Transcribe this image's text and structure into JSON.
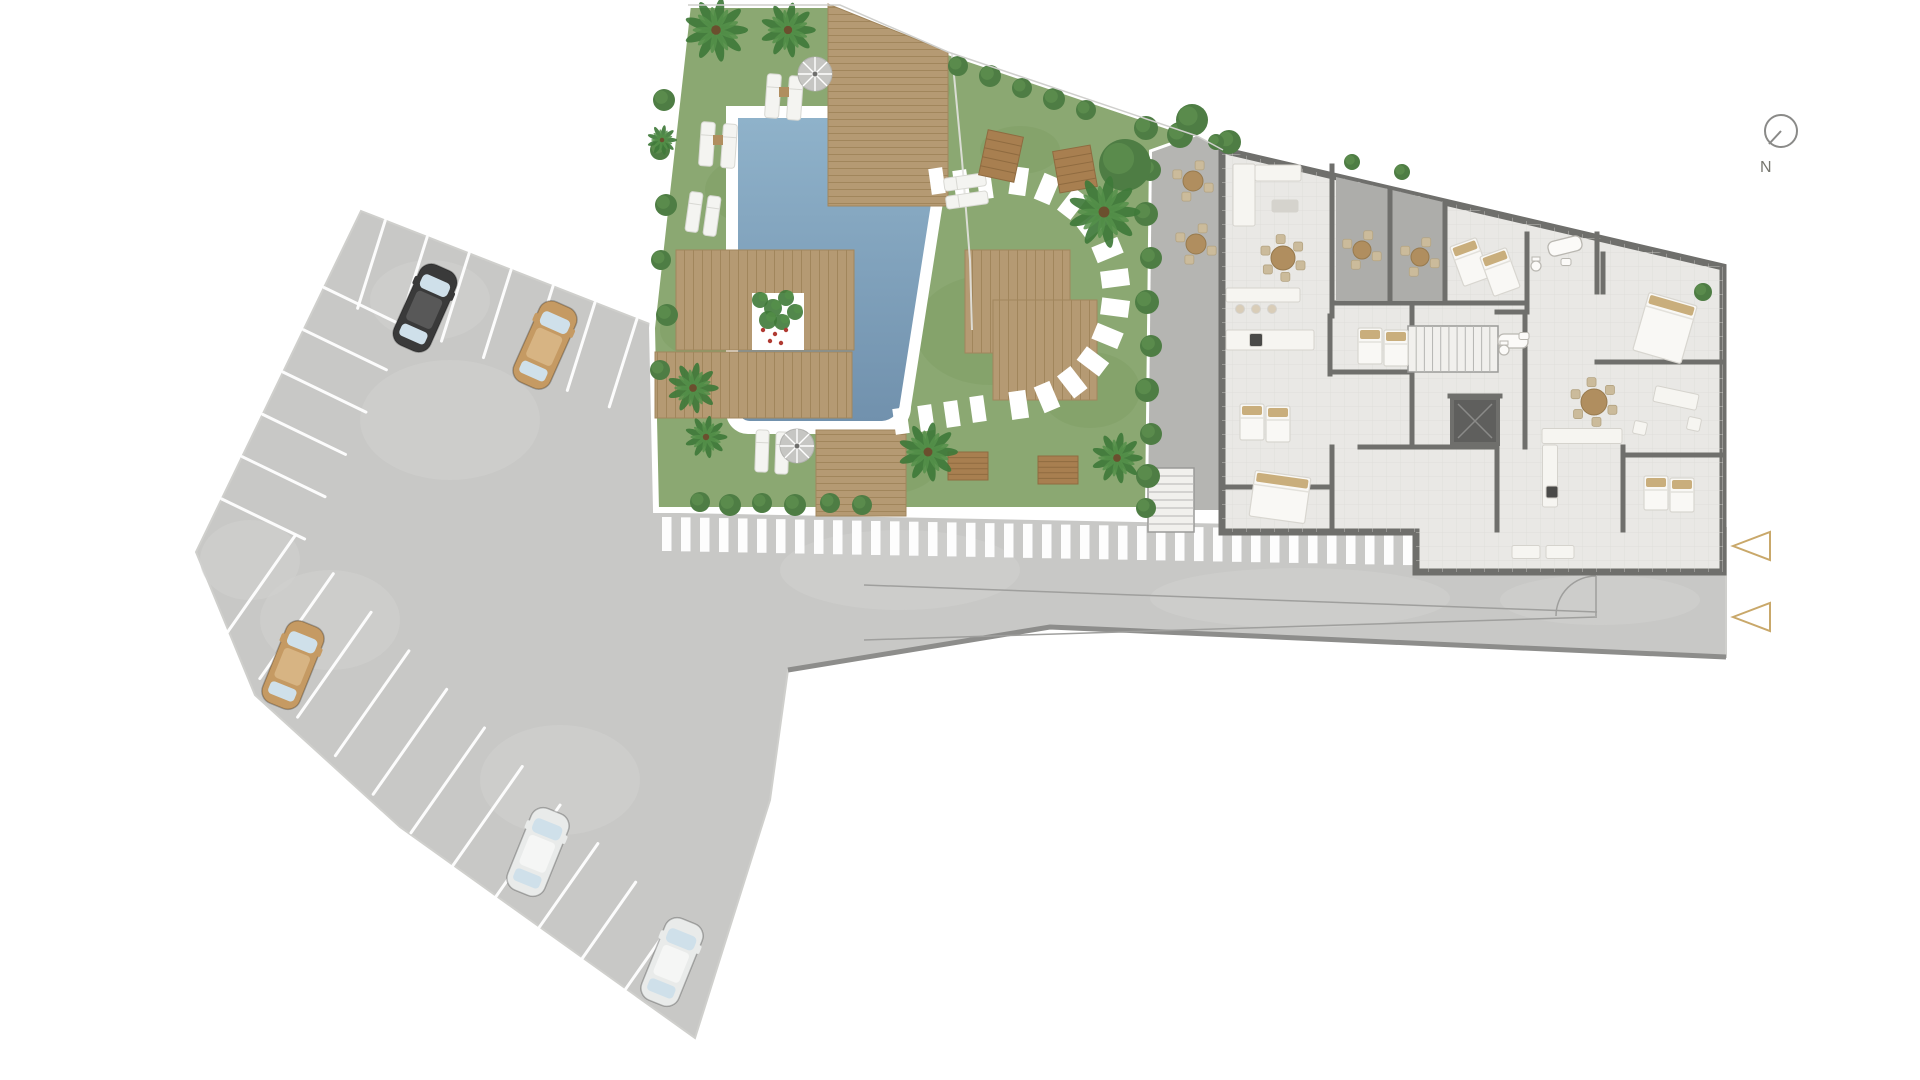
{
  "title": "residential-site-plan",
  "compass": {
    "label": "N",
    "cx": 1781,
    "cy": 131,
    "r": 16,
    "needle_x2": 1769,
    "needle_y2": 144,
    "label_x": 1760,
    "label_y": 172
  },
  "markers": [
    {
      "x": 1733,
      "y": 532,
      "w": 37,
      "h": 28,
      "dir": "left"
    },
    {
      "x": 1733,
      "y": 603,
      "w": 37,
      "h": 28,
      "dir": "left"
    }
  ],
  "colors": {
    "bg": "#ffffff",
    "asphalt": "#c8c8c6",
    "asphalt_light": "#d2d2d0",
    "asphalt_dark": "#bcbcba",
    "curb": "#8d8d8b",
    "lot_line": "#ffffff",
    "guide": "#9f9f9d",
    "grass": "#8ba872",
    "grass_dark": "#7c9a62",
    "bush": "#4e7d44",
    "bush_light": "#5f9150",
    "palm": "#3f7a39",
    "palm_light": "#55904a",
    "trunk": "#6b4f2e",
    "deck": "#b59a73",
    "deck_line": "#a1865c",
    "bench": "#a87f50",
    "bench_line": "#8f6b40",
    "pool_rim": "#ffffff",
    "water_top": "#8fb2ca",
    "water_bottom": "#7191ad",
    "stone": "#ffffff",
    "floor": "#e9e8e5",
    "tile": "#dddcd8",
    "wall": "#6f6f6c",
    "terrace": "#adadaa",
    "patio": "#b5b5b2",
    "furn": "#f6f5f1",
    "furn_stroke": "#d5d3cd",
    "pillow": "#c9ae7c",
    "wood": "#b08e5f",
    "appliance": "#4a4a48",
    "elevator": "#5f5f5d",
    "marker": "#c9a86a",
    "compass": "#8a8a88",
    "label": "#77776f",
    "boundary": "#cfcfcc",
    "fixture": "#fbfaf8",
    "fixture_stroke": "#b9b7b1",
    "glass": "#cfe0ea",
    "stairs": "#f1f0ed"
  },
  "site_paths": {
    "lot_road": "M361,211 L652,325 L656,510 L1726,528 L1726,657 L1050,627 L788,670 L770,800 L695,1038 L400,827 L255,695 L196,552 Z",
    "garden": "M688,5 L840,5 L948,52 L1197,136 L1152,152 L1148,510 L656,510 L652,328 Z",
    "patio": "M1152,152 L1197,136 L1223,150 L1223,510 L1148,510 Z",
    "building": "M1222,150 L1723,267 L1723,572 L1416,572 L1416,532 L1222,532 Z",
    "boundary": "688,5 840,5 948,52 1197,136 1223,150",
    "fence": "952,54 962,160 970,260 972,330",
    "curb_bottom": "1726,657 1050,627 788,670",
    "gate_arc": "M1556,616 A40,40 0 0 1 1596,576 M1596,576 L1596,616"
  },
  "pool": {
    "rim": "M726,106 L884,106 A63,66 0 0 1 947,177 L911,407 A27,27 0 0 1 886,434 L748,434 A22,22 0 0 1 726,412 Z",
    "water": "M738,118 L880,118 A55,57 0 0 1 935,178 L900,403 A19,19 0 0 1 882,421 L750,421 A12,12 0 0 1 738,409 Z"
  },
  "stall_rows": [
    {
      "x": 361,
      "y": 211,
      "dx": 0.932,
      "dy": 0.365,
      "nx": -0.3,
      "ny": 0.954,
      "len": 92,
      "t0": 26,
      "step": 45,
      "n": 7
    },
    {
      "x": 361,
      "y": 211,
      "dx": -0.435,
      "dy": 0.9,
      "nx": 0.9,
      "ny": 0.435,
      "len": 92,
      "t0": 85,
      "step": 47,
      "n": 6
    },
    {
      "x": 222,
      "y": 640,
      "dx": 0.7,
      "dy": 0.714,
      "nx": 0.574,
      "ny": -0.819,
      "len": 128,
      "t0": 0,
      "step": 54,
      "n": 11
    }
  ],
  "cars": [
    {
      "name": "car-black",
      "body": "#3a3a3a",
      "roof": "#585858",
      "x": 425,
      "y": 308,
      "rot": 24
    },
    {
      "name": "car-tan-top",
      "body": "#c59a63",
      "roof": "#d7b483",
      "x": 545,
      "y": 345,
      "rot": 24
    },
    {
      "name": "car-tan-mid",
      "body": "#c59a63",
      "roof": "#d7b483",
      "x": 293,
      "y": 665,
      "rot": 22
    },
    {
      "name": "car-white-1",
      "body": "#e9ebea",
      "roof": "#f5f6f5",
      "x": 538,
      "y": 852,
      "rot": 22
    },
    {
      "name": "car-white-2",
      "body": "#e9ebea",
      "roof": "#f5f6f5",
      "x": 672,
      "y": 962,
      "rot": 22
    }
  ],
  "crosswalk": {
    "x0": 662,
    "x1": 1404,
    "step": 19,
    "w": 9.5,
    "h": 34,
    "y0": 517,
    "slope": 0.019
  },
  "sidewalk": {
    "x1": 654,
    "y1": 508,
    "x2": 1416,
    "y2": 523
  },
  "guide_lines": [
    [
      864,
      585,
      1597,
      612
    ],
    [
      864,
      640,
      1597,
      617
    ]
  ],
  "road_patches": [
    [
      450,
      420,
      90,
      60
    ],
    [
      330,
      620,
      70,
      50
    ],
    [
      560,
      780,
      80,
      55
    ],
    [
      900,
      570,
      120,
      40
    ],
    [
      1300,
      598,
      150,
      30
    ],
    [
      1600,
      600,
      100,
      25
    ],
    [
      430,
      300,
      60,
      40
    ],
    [
      250,
      560,
      50,
      40
    ]
  ],
  "grass_patches": [
    [
      770,
      190,
      65,
      38
    ],
    [
      900,
      90,
      50,
      30
    ],
    [
      990,
      330,
      75,
      55
    ],
    [
      880,
      470,
      55,
      25
    ],
    [
      705,
      330,
      45,
      28
    ],
    [
      1090,
      390,
      50,
      38
    ],
    [
      1020,
      150,
      40,
      24
    ]
  ],
  "decks": [
    {
      "pts": "828,4 948,52 948,206 828,206",
      "pat": "H"
    },
    {
      "pts": "676,250 854,250 854,350 676,350",
      "pat": "V"
    },
    {
      "pts": "655,352 852,352 852,418 655,418",
      "pat": "V"
    },
    {
      "pts": "816,430 906,430 906,516 816,516",
      "pat": "H"
    },
    {
      "pts": "965,250 1070,250 1070,353 965,353",
      "pat": "V"
    },
    {
      "pts": "993,300 1097,300 1097,400 993,400",
      "pat": "V"
    }
  ],
  "planter": {
    "x": 752,
    "y": 293,
    "w": 52,
    "h": 57,
    "greens": [
      [
        760,
        300,
        8
      ],
      [
        773,
        308,
        9
      ],
      [
        786,
        298,
        8
      ],
      [
        768,
        320,
        9
      ],
      [
        782,
        322,
        8
      ],
      [
        795,
        312,
        8
      ]
    ],
    "reds": [
      [
        763,
        330
      ],
      [
        775,
        334
      ],
      [
        786,
        330
      ],
      [
        770,
        341
      ],
      [
        781,
        343
      ]
    ]
  },
  "stones_arc": {
    "cx": 1003,
    "cy": 293,
    "r": 113,
    "a0": -82,
    "a1": 82,
    "n": 12,
    "w": 17,
    "h": 28
  },
  "stones_extra": [
    [
      985,
      186
    ],
    [
      961,
      183
    ],
    [
      937,
      181
    ],
    [
      978,
      409
    ],
    [
      952,
      414
    ],
    [
      926,
      418
    ],
    [
      901,
      421
    ]
  ],
  "loungers": [
    {
      "x": 773,
      "y": 96,
      "w": 14,
      "h": 44,
      "rot": 4
    },
    {
      "x": 795,
      "y": 98,
      "w": 14,
      "h": 44,
      "rot": 4
    },
    {
      "x": 707,
      "y": 144,
      "w": 14,
      "h": 44,
      "rot": 4
    },
    {
      "x": 729,
      "y": 146,
      "w": 14,
      "h": 44,
      "rot": 4
    },
    {
      "x": 694,
      "y": 212,
      "w": 13,
      "h": 40,
      "rot": 8
    },
    {
      "x": 712,
      "y": 216,
      "w": 13,
      "h": 40,
      "rot": 8
    },
    {
      "x": 762,
      "y": 451,
      "w": 13,
      "h": 42,
      "rot": 2
    },
    {
      "x": 782,
      "y": 453,
      "w": 13,
      "h": 42,
      "rot": 2
    },
    {
      "x": 965,
      "y": 182,
      "w": 42,
      "h": 13,
      "rot": -8
    },
    {
      "x": 967,
      "y": 200,
      "w": 42,
      "h": 13,
      "rot": -8
    }
  ],
  "lounger_tables": [
    [
      784,
      92
    ],
    [
      718,
      140
    ]
  ],
  "umbrellas": [
    [
      815,
      74,
      17
    ],
    [
      797,
      446,
      17
    ]
  ],
  "benches": [
    {
      "x": 1001,
      "y": 156,
      "w": 36,
      "h": 46,
      "rot": 12
    },
    {
      "x": 1075,
      "y": 169,
      "w": 38,
      "h": 42,
      "rot": -10
    },
    {
      "x": 968,
      "y": 466,
      "w": 40,
      "h": 28,
      "rot": 0
    },
    {
      "x": 1058,
      "y": 470,
      "w": 40,
      "h": 28,
      "rot": 0
    }
  ],
  "palms": [
    [
      716,
      30,
      30
    ],
    [
      788,
      30,
      26
    ],
    [
      693,
      388,
      24
    ],
    [
      706,
      437,
      20
    ],
    [
      928,
      452,
      28
    ],
    [
      1104,
      212,
      34
    ],
    [
      1117,
      458,
      24
    ],
    [
      662,
      140,
      14
    ]
  ],
  "bushes": [
    [
      664,
      100,
      11
    ],
    [
      660,
      150,
      10
    ],
    [
      666,
      205,
      11
    ],
    [
      661,
      260,
      10
    ],
    [
      667,
      315,
      11
    ],
    [
      660,
      370,
      10
    ],
    [
      700,
      502,
      10
    ],
    [
      730,
      505,
      11
    ],
    [
      762,
      503,
      10
    ],
    [
      795,
      505,
      11
    ],
    [
      830,
      503,
      10
    ],
    [
      862,
      505,
      10
    ],
    [
      1146,
      128,
      12
    ],
    [
      1150,
      170,
      11
    ],
    [
      1146,
      214,
      12
    ],
    [
      1151,
      258,
      11
    ],
    [
      1147,
      302,
      12
    ],
    [
      1151,
      346,
      11
    ],
    [
      1147,
      390,
      12
    ],
    [
      1151,
      434,
      11
    ],
    [
      1148,
      476,
      12
    ],
    [
      1146,
      508,
      10
    ],
    [
      958,
      66,
      10
    ],
    [
      990,
      76,
      11
    ],
    [
      1022,
      88,
      10
    ],
    [
      1054,
      99,
      11
    ],
    [
      1086,
      110,
      10
    ],
    [
      1125,
      165,
      26
    ],
    [
      1180,
      135,
      13
    ],
    [
      1192,
      120,
      16
    ],
    [
      1229,
      142,
      12
    ],
    [
      1216,
      142,
      8
    ],
    [
      1352,
      162,
      8
    ],
    [
      1402,
      172,
      8
    ],
    [
      1703,
      292,
      9
    ]
  ],
  "terraces": [
    {
      "pts": "1336,177 1388,189 1388,300 1336,300"
    },
    {
      "pts": "1392,190 1443,202 1443,300 1392,300"
    }
  ],
  "walls": [
    [
      1332,
      166,
      1332,
      316
    ],
    [
      1334,
      303,
      1527,
      303
    ],
    [
      1390,
      190,
      1390,
      303
    ],
    [
      1445,
      202,
      1445,
      303
    ],
    [
      1527,
      234,
      1527,
      312
    ],
    [
      1597,
      234,
      1597,
      292
    ],
    [
      1497,
      312,
      1527,
      312
    ],
    [
      1330,
      316,
      1330,
      374
    ],
    [
      1330,
      372,
      1412,
      372
    ],
    [
      1412,
      305,
      1412,
      447
    ],
    [
      1360,
      447,
      1497,
      447
    ],
    [
      1497,
      447,
      1497,
      530
    ],
    [
      1222,
      487,
      1330,
      487
    ],
    [
      1332,
      447,
      1332,
      530
    ],
    [
      1525,
      312,
      1525,
      447
    ],
    [
      1603,
      254,
      1603,
      292
    ],
    [
      1597,
      362,
      1724,
      362
    ],
    [
      1623,
      447,
      1623,
      530
    ],
    [
      1623,
      455,
      1724,
      455
    ],
    [
      1450,
      396,
      1500,
      396
    ]
  ],
  "stairs": [
    {
      "x": 1408,
      "y": 326,
      "w": 90,
      "h": 46,
      "dir": "h",
      "n": 11
    },
    {
      "x": 1148,
      "y": 468,
      "w": 46,
      "h": 64,
      "dir": "v",
      "n": 8
    }
  ],
  "elevator": {
    "x": 1452,
    "y": 398,
    "w": 46,
    "h": 46
  },
  "beds": [
    {
      "x": 1470,
      "y": 262,
      "w": 28,
      "h": 42,
      "rot": -20
    },
    {
      "x": 1500,
      "y": 272,
      "w": 28,
      "h": 42,
      "rot": -20
    },
    {
      "x": 1665,
      "y": 328,
      "w": 50,
      "h": 60,
      "rot": 16
    },
    {
      "x": 1370,
      "y": 346,
      "w": 24,
      "h": 36,
      "rot": 0
    },
    {
      "x": 1396,
      "y": 348,
      "w": 24,
      "h": 36,
      "rot": 0
    },
    {
      "x": 1252,
      "y": 422,
      "w": 24,
      "h": 36,
      "rot": 0
    },
    {
      "x": 1278,
      "y": 424,
      "w": 24,
      "h": 36,
      "rot": 0
    },
    {
      "x": 1280,
      "y": 497,
      "w": 56,
      "h": 46,
      "rot": 8
    },
    {
      "x": 1656,
      "y": 493,
      "w": 24,
      "h": 34,
      "rot": 0
    },
    {
      "x": 1682,
      "y": 495,
      "w": 24,
      "h": 34,
      "rot": 0
    }
  ],
  "tables": [
    {
      "x": 1362,
      "y": 250,
      "r": 9,
      "ch": 4
    },
    {
      "x": 1420,
      "y": 257,
      "r": 9,
      "ch": 4
    },
    {
      "x": 1283,
      "y": 258,
      "r": 12,
      "ch": 6
    },
    {
      "x": 1594,
      "y": 402,
      "r": 13,
      "ch": 6
    },
    {
      "x": 1193,
      "y": 181,
      "r": 10,
      "ch": 4
    },
    {
      "x": 1196,
      "y": 244,
      "r": 10,
      "ch": 4
    }
  ],
  "furn_rects": [
    {
      "x": 1244,
      "y": 195,
      "w": 22,
      "h": 62,
      "rot": 0,
      "f": "furn"
    },
    {
      "x": 1278,
      "y": 173,
      "w": 46,
      "h": 16,
      "rot": 0,
      "f": "furn"
    },
    {
      "x": 1285,
      "y": 206,
      "w": 26,
      "h": 12,
      "rot": 0,
      "f": "furn_stroke"
    },
    {
      "x": 1263,
      "y": 295,
      "w": 74,
      "h": 14,
      "rot": 0,
      "f": "furn"
    },
    {
      "x": 1270,
      "y": 340,
      "w": 88,
      "h": 20,
      "rot": 0,
      "f": "furn"
    },
    {
      "x": 1256,
      "y": 340,
      "w": 13,
      "h": 13,
      "rot": 0,
      "f": "appliance"
    },
    {
      "x": 1582,
      "y": 436,
      "w": 80,
      "h": 15,
      "rot": 0,
      "f": "furn"
    },
    {
      "x": 1550,
      "y": 476,
      "w": 15,
      "h": 62,
      "rot": 0,
      "f": "furn"
    },
    {
      "x": 1552,
      "y": 492,
      "w": 12,
      "h": 12,
      "rot": 0,
      "f": "appliance"
    },
    {
      "x": 1676,
      "y": 398,
      "w": 44,
      "h": 16,
      "rot": 12,
      "f": "furn"
    },
    {
      "x": 1640,
      "y": 428,
      "w": 13,
      "h": 13,
      "rot": 12,
      "f": "furn"
    },
    {
      "x": 1694,
      "y": 424,
      "w": 13,
      "h": 13,
      "rot": 12,
      "f": "furn"
    },
    {
      "x": 1526,
      "y": 552,
      "w": 28,
      "h": 13,
      "rot": 0,
      "f": "furn"
    },
    {
      "x": 1560,
      "y": 552,
      "w": 28,
      "h": 13,
      "rot": 0,
      "f": "furn"
    }
  ],
  "stools": [
    [
      1240,
      309
    ],
    [
      1256,
      309
    ],
    [
      1272,
      309
    ]
  ],
  "tubs": [
    {
      "x": 1565,
      "y": 246,
      "w": 34,
      "h": 15,
      "rot": -14
    },
    {
      "x": 1513,
      "y": 341,
      "w": 30,
      "h": 14,
      "rot": 0
    }
  ],
  "toilets": [
    [
      1536,
      266
    ],
    [
      1504,
      350
    ]
  ],
  "sinks": [
    [
      1566,
      262
    ],
    [
      1524,
      336
    ]
  ]
}
